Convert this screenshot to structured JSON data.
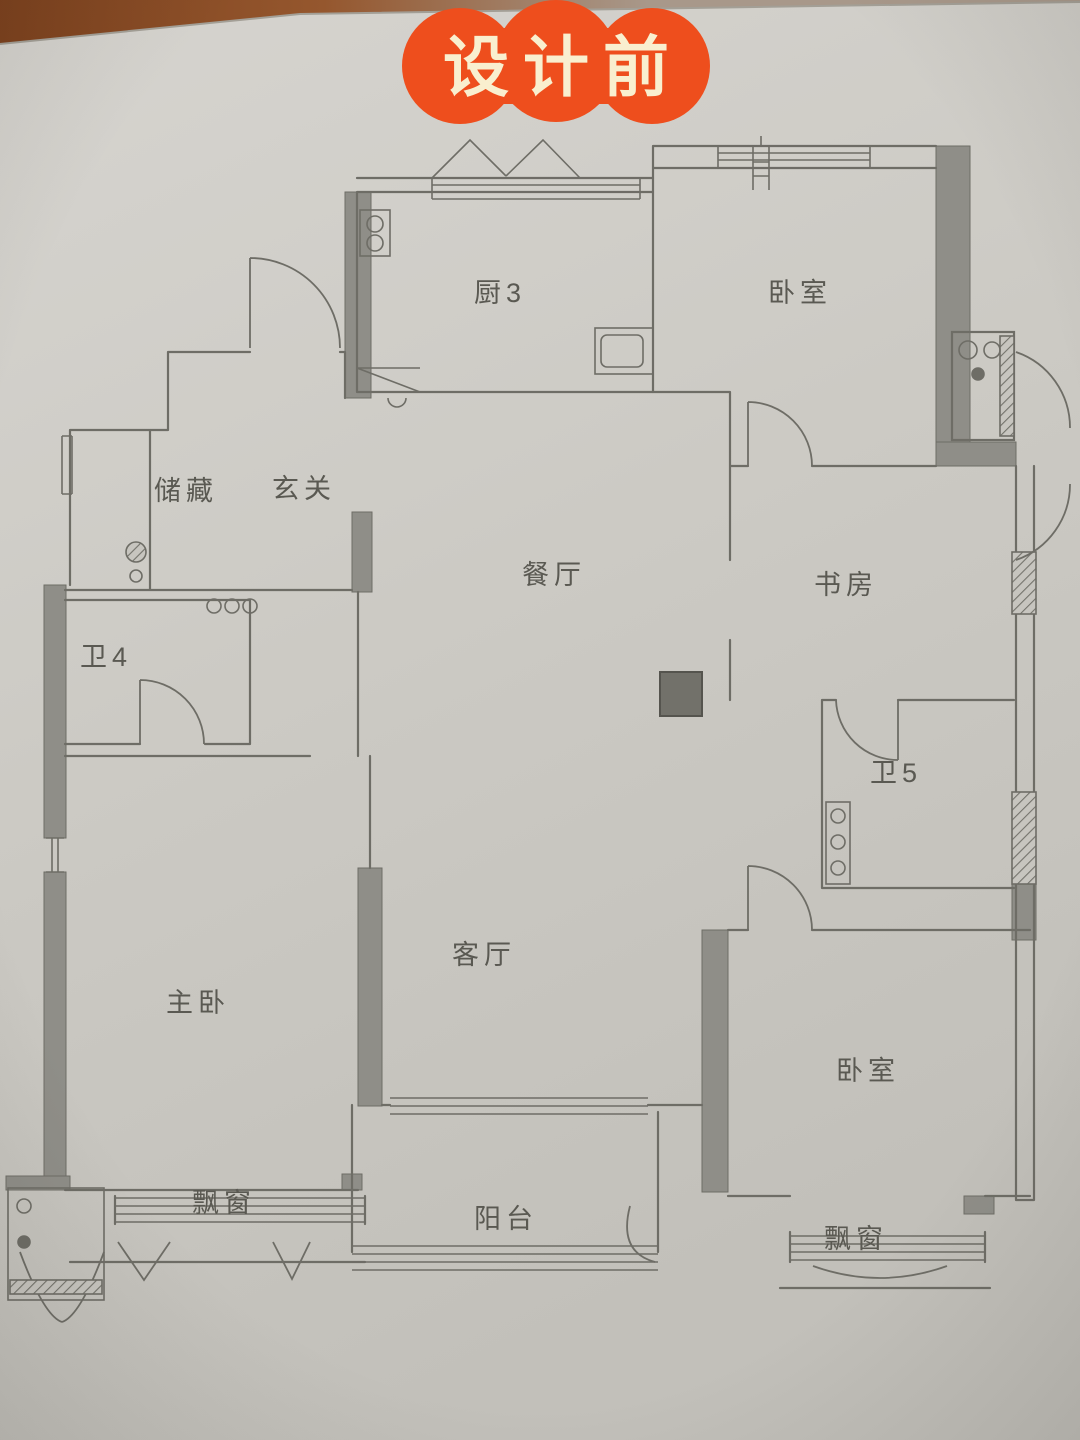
{
  "badge": {
    "label": "设计前",
    "bg_color": "#ee4e1d",
    "text_color": "#f9efcf"
  },
  "plan": {
    "rooms": [
      {
        "id": "kitchen",
        "label": "厨3"
      },
      {
        "id": "bedroom-top",
        "label": "卧室"
      },
      {
        "id": "storage",
        "label": "储藏"
      },
      {
        "id": "entry-hall",
        "label": "玄关"
      },
      {
        "id": "dining-room",
        "label": "餐厅"
      },
      {
        "id": "study",
        "label": "书房"
      },
      {
        "id": "bathroom-4",
        "label": "卫4"
      },
      {
        "id": "bathroom-5",
        "label": "卫5"
      },
      {
        "id": "master-bedroom",
        "label": "主卧"
      },
      {
        "id": "living-room",
        "label": "客厅"
      },
      {
        "id": "bedroom-bottom",
        "label": "卧室"
      },
      {
        "id": "bay-window-left",
        "label": "飘窗"
      },
      {
        "id": "balcony",
        "label": "阳台"
      },
      {
        "id": "bay-window-right",
        "label": "飘窗"
      }
    ],
    "colors": {
      "paper": "#cdcac4",
      "pencil_line": "#6e6d66",
      "wall_fill": "#8f8e88",
      "column_fill": "#72716a",
      "wood_table": "#8a4f2a"
    }
  }
}
